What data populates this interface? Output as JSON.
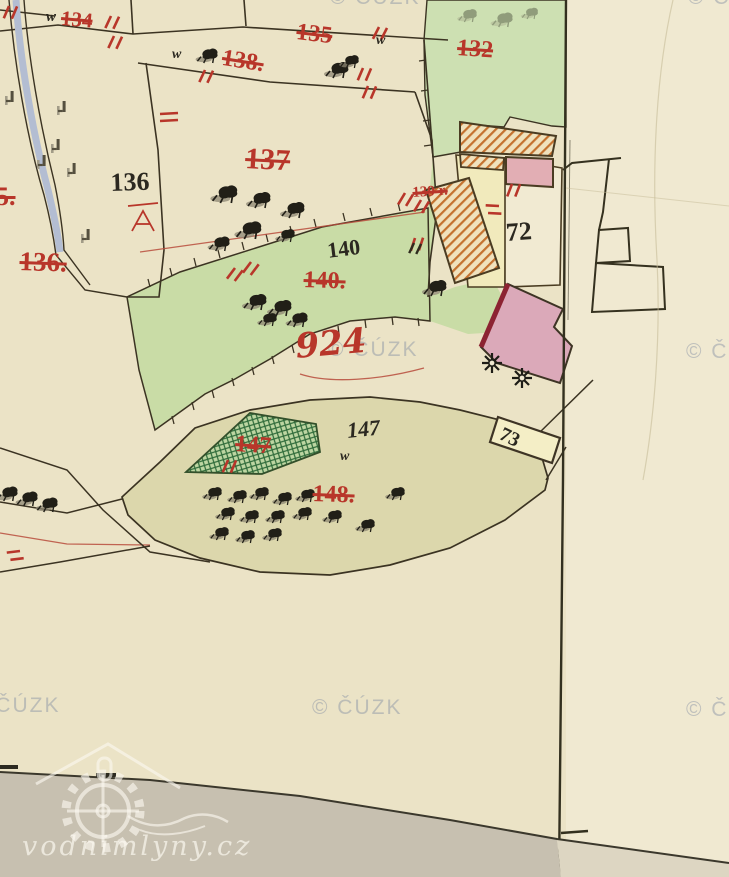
{
  "map": {
    "attribution_watermark": "© ČÚZK",
    "source_logo": "vodnimlyny.cz",
    "labels": {
      "red_parcel_numbers": {
        "p55": "5.",
        "p134": "134",
        "p135": "135",
        "p136": "136.",
        "p137": "137",
        "p138": "138.",
        "p139": "139 r.",
        "p140": "140.",
        "p132": "132",
        "p147": "147",
        "p148": "148.",
        "road": "924"
      },
      "black_house_numbers": {
        "p136": "136",
        "p140": "140",
        "p147": "147",
        "h72": "72",
        "h73": "73"
      },
      "letters": {
        "w1": "w",
        "w2": "w",
        "w3": "w",
        "w4": "w"
      }
    },
    "colors": {
      "paper": "#ebe3c6",
      "paper_right": "#f0e9d1",
      "meadow_green": "#c9dca6",
      "pond_green": "#bdd6a2",
      "pond_hatch": "#2f6b3a",
      "olive_parcel": "#dcd7ac",
      "yellow_parcel": "#f1eabc",
      "pink_building": "#e2aeb4",
      "mill_pink": "#dba9b9",
      "mill_edge": "#8c2332",
      "wood_hatch": "#c4722f",
      "red_label": "#b8362a",
      "ink": "#3b3322",
      "road_gray": "#c7c0b0",
      "watermark": "#7d88a0"
    }
  }
}
